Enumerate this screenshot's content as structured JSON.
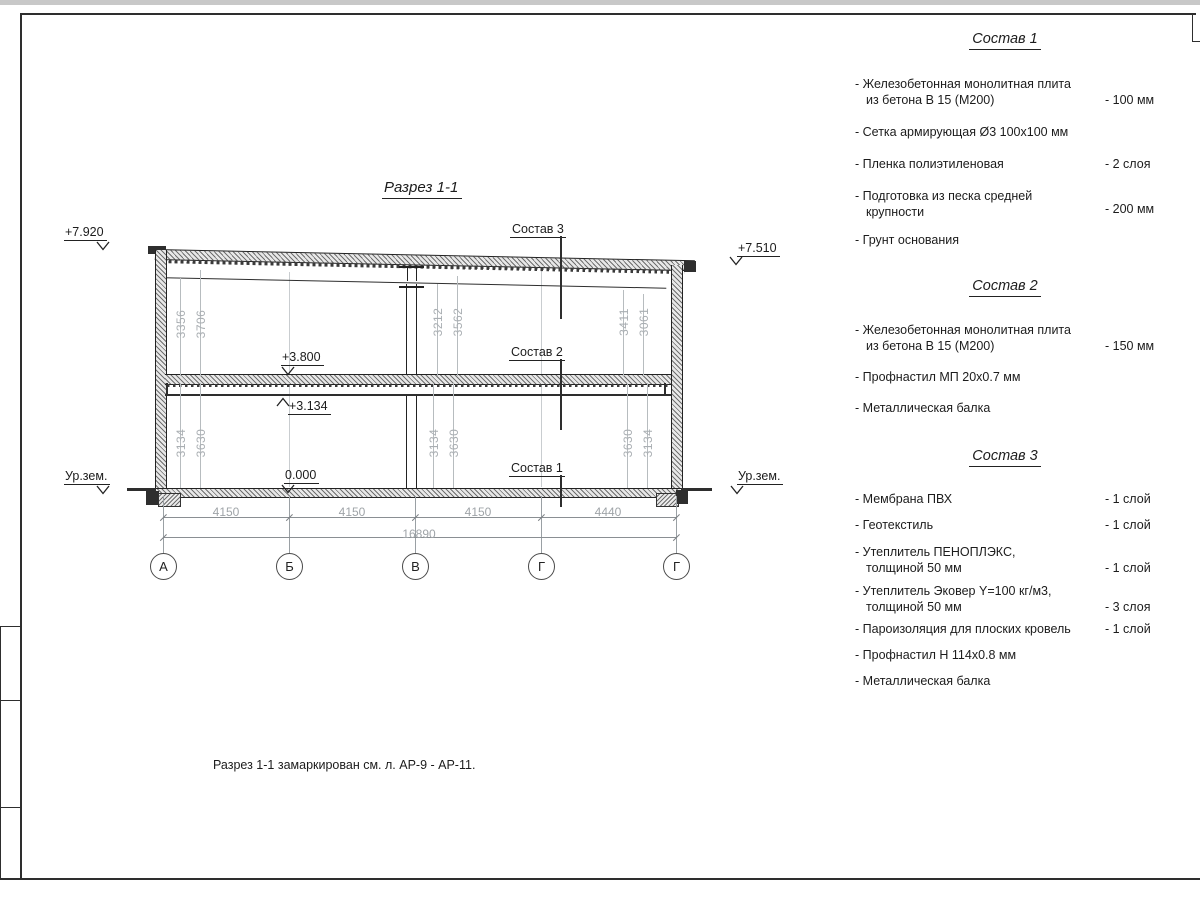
{
  "title": "Разрез 1-1",
  "note": "Разрез 1-1 замаркирован см. л. АР-9 - АР-11.",
  "elevations": {
    "top_left": "+7.920",
    "top_right": "+7.510",
    "floor2": "+3.800",
    "beam": "+3.134",
    "zero": "0.000",
    "ground_left": "Ур.зем.",
    "ground_right": "Ур.зем."
  },
  "leader_labels": {
    "c1": "Состав 1",
    "c2": "Состав 2",
    "c3": "Состав 3"
  },
  "axis_bubbles": [
    "А",
    "Б",
    "В",
    "Г",
    "Г"
  ],
  "h_dims": {
    "d1": "4150",
    "d2": "4150",
    "d3": "4150",
    "d4": "4440",
    "total": "16890"
  },
  "v_dims": {
    "up_left_inner": "3356",
    "up_left_outer": "3706",
    "up_mid_inner": "3212",
    "up_mid_outer": "3562",
    "up_right_inner": "3411",
    "up_right_outer": "3061",
    "low_left_inner": "3134",
    "low_left_outer": "3630",
    "low_mid_inner": "3134",
    "low_mid_outer": "3630",
    "low_right_inner": "3630",
    "low_right_outer": "3134"
  },
  "comp1": {
    "title": "Состав 1",
    "items": [
      {
        "line1": "- Железобетонная  монолитная плита",
        "line2": "из бетона В 15 (М200)",
        "value": "- 100 мм"
      },
      {
        "line1": "- Сетка армирующая Ø3 100х100 мм"
      },
      {
        "line1": "- Пленка полиэтиленовая",
        "value": "-  2 слоя"
      },
      {
        "line1": "- Подготовка из песка средней",
        "line2": "крупности",
        "value": "- 200 мм"
      },
      {
        "line1": "- Грунт основания"
      }
    ]
  },
  "comp2": {
    "title": "Состав 2",
    "items": [
      {
        "line1": "- Железобетонная  монолитная плита",
        "line2": "из бетона В 15 (М200)",
        "value": "- 150 мм"
      },
      {
        "line1": "- Профнастил МП 20х0.7 мм"
      },
      {
        "line1": "- Металлическая балка"
      }
    ]
  },
  "comp3": {
    "title": "Состав 3",
    "items": [
      {
        "line1": "- Мембрана ПВХ",
        "value": "- 1 слой"
      },
      {
        "line1": "- Геотекстиль",
        "value": "- 1 слой"
      },
      {
        "line1": "- Утеплитель ПЕНОПЛЭКС,",
        "line2": "толщиной 50 мм",
        "value": "- 1 слой"
      },
      {
        "line1": "- Утеплитель Эковер Y=100 кг/м3,",
        "line2": "толщиной 50 мм",
        "value": "- 3 слоя"
      },
      {
        "line1": "- Пароизоляция для плоских кровель",
        "value": "- 1 слой"
      },
      {
        "line1": "- Профнастил Н 114х0.8 мм"
      },
      {
        "line1": "- Металлическая балка"
      }
    ]
  }
}
